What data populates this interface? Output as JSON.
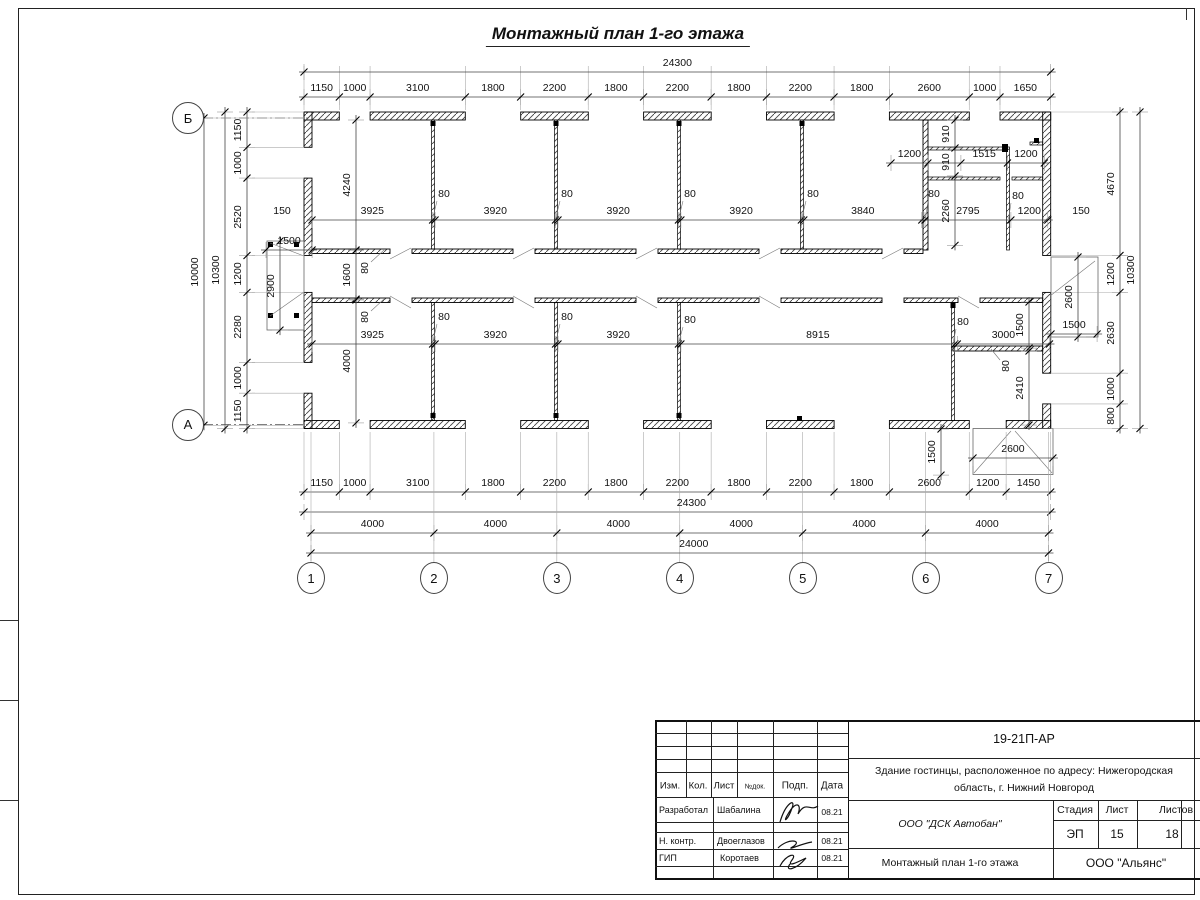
{
  "sheet": {
    "title": "Монтажный план 1-го этажа"
  },
  "plan": {
    "axes": {
      "cols": [
        {
          "t": "1",
          "x": 311
        },
        {
          "t": "2",
          "x": 433.9
        },
        {
          "t": "3",
          "x": 556.9
        },
        {
          "t": "4",
          "x": 679.8
        },
        {
          "t": "5",
          "x": 802.8
        },
        {
          "t": "6",
          "x": 925.7
        },
        {
          "t": "7",
          "x": 1048.6
        }
      ],
      "cols_y": 578,
      "rows": [
        {
          "t": "Б",
          "x": 188,
          "y": 118
        },
        {
          "t": "А",
          "x": 188,
          "y": 424.5
        }
      ]
    },
    "chains": [
      {
        "d": "h",
        "x": 304,
        "y": 97,
        "ext": [
          66,
          110
        ],
        "s": [
          1150,
          1000,
          3100,
          1800,
          2200,
          1800,
          2200,
          1800,
          2200,
          1800,
          2600,
          1000,
          1650
        ]
      },
      {
        "d": "h",
        "x": 304,
        "y": 72,
        "s": [
          24300
        ]
      },
      {
        "d": "h",
        "x": 304,
        "y": 492,
        "ext": [
          432,
          496
        ],
        "s": [
          1150,
          1000,
          3100,
          1800,
          2200,
          1800,
          2200,
          1800,
          2200,
          1800,
          2600,
          1200,
          1450
        ]
      },
      {
        "d": "h",
        "x": 304,
        "y": 512,
        "dx": 14,
        "s": [
          24300
        ]
      },
      {
        "d": "h",
        "x": 311,
        "y": 533,
        "ext": [
          432,
          562
        ],
        "s": [
          4000,
          4000,
          4000,
          4000,
          4000,
          4000
        ]
      },
      {
        "d": "h",
        "x": 311,
        "y": 553,
        "dx": 14,
        "s": [
          24000
        ]
      },
      {
        "d": "v",
        "x": 247,
        "y": 112,
        "ext": [
          252,
          304
        ],
        "s": [
          1150,
          1000,
          2520,
          1200,
          2280,
          1000,
          1150
        ]
      },
      {
        "d": "v",
        "x": 225,
        "y": 112,
        "s": [
          10300
        ]
      },
      {
        "d": "v",
        "x": 204,
        "y": 118,
        "ext": [
          208,
          304
        ],
        "s": [
          10000
        ]
      },
      {
        "d": "v",
        "x": 1120,
        "y": 112,
        "ext": [
          1051,
          1126
        ],
        "s": [
          4670,
          1200,
          2630,
          1000,
          800
        ]
      },
      {
        "d": "v",
        "x": 1140,
        "y": 112,
        "s": [
          10300
        ]
      },
      {
        "d": "h",
        "x": 312,
        "y": 220,
        "s": [
          3925,
          [
            80
          ],
          3920,
          [
            80
          ],
          3920,
          [
            80
          ],
          3920,
          [
            80
          ],
          3840
        ]
      },
      {
        "d": "h",
        "x": 312,
        "y": 344,
        "s": [
          3925,
          [
            80
          ],
          3920,
          [
            80
          ],
          3920,
          [
            80
          ],
          8915,
          [
            80
          ],
          3000
        ]
      },
      {
        "d": "v",
        "x": 356,
        "y": 120,
        "s": [
          4240
        ]
      },
      {
        "d": "v",
        "x": 356,
        "y": 250,
        "s": [
          1600
        ]
      },
      {
        "d": "v",
        "x": 356,
        "y": 300,
        "s": [
          4000
        ]
      },
      {
        "d": "v",
        "x": 955,
        "y": 120,
        "s": [
          910,
          910,
          2260
        ]
      },
      {
        "d": "h",
        "x": 891,
        "y": 163,
        "s": [
          1200,
          [
            1075
          ],
          1515,
          1200
        ]
      },
      {
        "d": "h",
        "x": 925,
        "y": 220,
        "s": [
          2795,
          1200
        ]
      },
      {
        "d": "v",
        "x": 1029,
        "y": 302,
        "s": [
          1500
        ]
      },
      {
        "d": "v",
        "x": 1029,
        "y": 351,
        "s": [
          2410
        ]
      },
      {
        "d": "v",
        "x": 1078,
        "y": 257,
        "s": [
          2600
        ]
      },
      {
        "d": "h",
        "x": 1051,
        "y": 334,
        "s": [
          1500
        ]
      },
      {
        "d": "h",
        "x": 266,
        "y": 250,
        "s": [
          1500
        ]
      },
      {
        "d": "v",
        "x": 280,
        "y": 241,
        "s": [
          2900
        ]
      },
      {
        "d": "h",
        "x": 973,
        "y": 458,
        "s": [
          2600
        ]
      },
      {
        "d": "v",
        "x": 941,
        "y": 429,
        "s": [
          1500
        ]
      }
    ],
    "labels": [
      {
        "t": "80",
        "x": 444,
        "y": 194
      },
      {
        "t": "80",
        "x": 567,
        "y": 194
      },
      {
        "t": "80",
        "x": 690,
        "y": 194
      },
      {
        "t": "80",
        "x": 813,
        "y": 194
      },
      {
        "t": "80",
        "x": 934,
        "y": 194
      },
      {
        "t": "80",
        "x": 1018,
        "y": 196
      },
      {
        "t": "80",
        "x": 444,
        "y": 317
      },
      {
        "t": "80",
        "x": 567,
        "y": 317
      },
      {
        "t": "80",
        "x": 690,
        "y": 320
      },
      {
        "t": "80",
        "x": 963,
        "y": 322
      },
      {
        "t": "80",
        "x": 365,
        "y": 268,
        "r": 1
      },
      {
        "t": "80",
        "x": 365,
        "y": 317,
        "r": 1
      },
      {
        "t": "80",
        "x": 1006,
        "y": 366,
        "r": 1
      },
      {
        "t": "150",
        "x": 282,
        "y": 211
      },
      {
        "t": "150",
        "x": 1081,
        "y": 211
      }
    ]
  },
  "title_block": {
    "code": "19-21П-АР",
    "building_line1": "Здание гостинцы, расположенное по адресу: Нижегородская",
    "building_line2": "область, г. Нижний Новгород",
    "cols": {
      "izm": "Изм.",
      "kol": "Кол.",
      "list": "Лист",
      "ndok": "№док.",
      "podp": "Подп.",
      "data": "Дата"
    },
    "rows": [
      {
        "role": "Разработал",
        "name": "Шабалина",
        "date": "08.21"
      },
      {
        "role": "Н. контр.",
        "name": "Двоеглазов",
        "date": "08.21"
      },
      {
        "role": "ГИП",
        "name": "Коротаев",
        "date": "08.21"
      }
    ],
    "org": "ООО \"ДСК Автобан\"",
    "stage_label": "Стадия",
    "sheet_label": "Лист",
    "sheets_label": "Листов",
    "stage": "ЭП",
    "sheet_no": "15",
    "sheets_total": "18",
    "drawing_name": "Монтажный план 1-го этажа",
    "firm": "ООО \"Альянс\""
  }
}
